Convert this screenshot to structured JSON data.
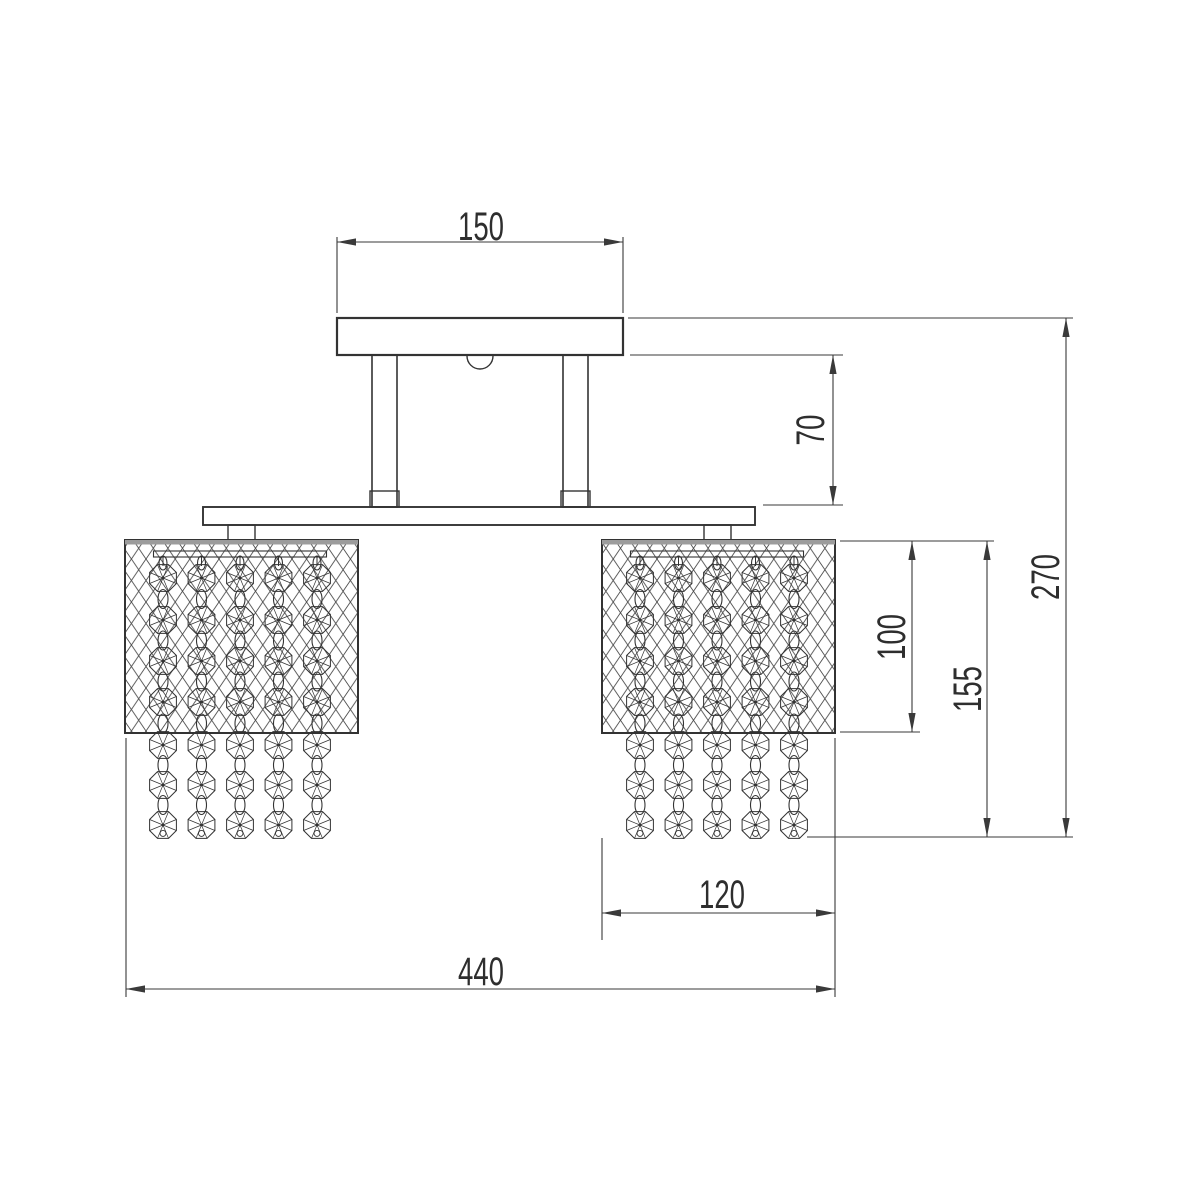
{
  "page": {
    "background": "#ffffff"
  },
  "drawing": {
    "type": "technical-dimension-drawing",
    "subject": "two-shade crystal ceiling chandelier, front elevation",
    "colors": {
      "line": "#333333",
      "dim": "#3a3a3a",
      "text": "#2e2e2e",
      "mesh": "#4a4a4a",
      "shade_top_strip": "#9c9c9c",
      "background": "#ffffff"
    },
    "dimensions": [
      {
        "id": "canopy-width",
        "label": "150",
        "orientation": "horizontal"
      },
      {
        "id": "drop-canopy-to-bar",
        "label": "70",
        "orientation": "vertical"
      },
      {
        "id": "overall-height",
        "label": "270",
        "orientation": "vertical"
      },
      {
        "id": "shade-height",
        "label": "100",
        "orientation": "vertical"
      },
      {
        "id": "shade-plus-pendants",
        "label": "155",
        "orientation": "vertical"
      },
      {
        "id": "shade-width",
        "label": "120",
        "orientation": "horizontal"
      },
      {
        "id": "overall-width",
        "label": "440",
        "orientation": "horizontal"
      }
    ]
  }
}
